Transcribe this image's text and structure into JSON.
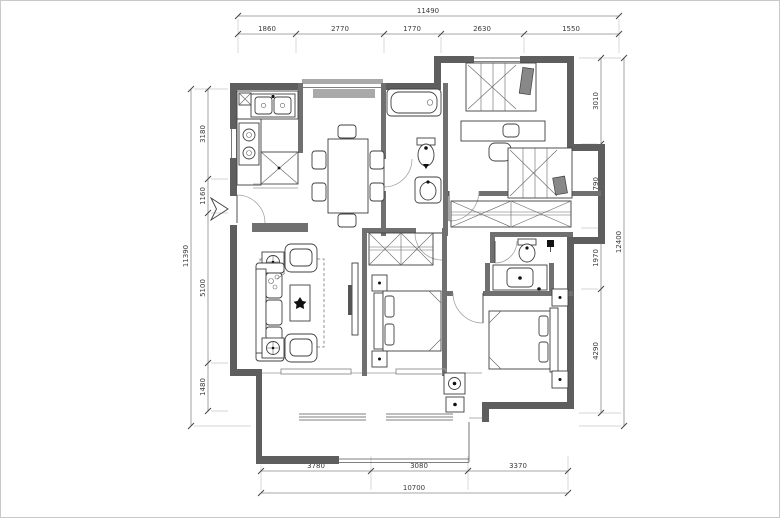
{
  "plan": {
    "type": "apartment-floor-plan",
    "dims_top": {
      "total": "11490",
      "segments": [
        "1860",
        "2770",
        "1770",
        "2630",
        "1550"
      ]
    },
    "dims_left": {
      "total": "11390",
      "segments": [
        "3180",
        "1160",
        "5100",
        "1480"
      ]
    },
    "dims_right": {
      "total": "12400",
      "segments": [
        "3010",
        "2790",
        "1970",
        "4290"
      ]
    },
    "dims_bottom": {
      "total": "10700",
      "segments": [
        "3780",
        "3080",
        "3370"
      ]
    },
    "colors": {
      "exterior_wall": "#5e5e5e",
      "interior_wall": "#707070",
      "dimension_text": "#3a3a3a",
      "furniture_line": "#3f3f3f"
    }
  }
}
